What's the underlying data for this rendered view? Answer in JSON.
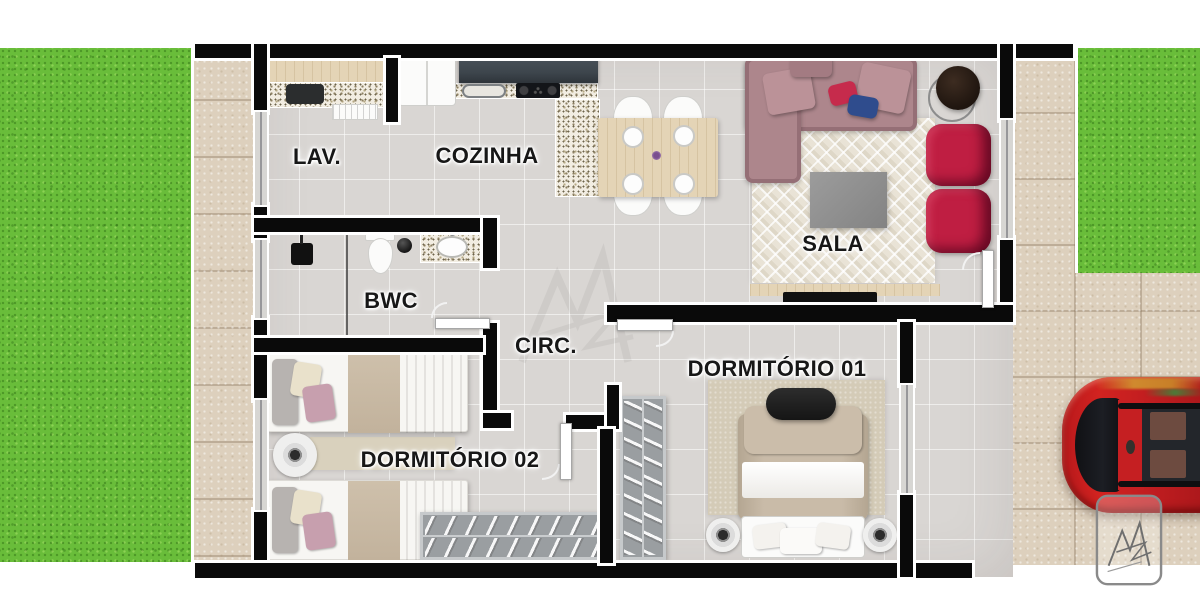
{
  "rooms": {
    "lav": "LAV.",
    "cozinha": "COZINHA",
    "sala": "SALA",
    "bwc": "BWC",
    "circ": "CIRC.",
    "dorm1": "DORMITÓRIO 01",
    "dorm2": "DORMITÓRIO 02"
  },
  "colors": {
    "grass": "#69bd3a",
    "paving": "#ddd0bd",
    "floor": "#d9d6d3",
    "wall": "#0a0a0a",
    "sofa": "#ad868c",
    "armchair": "#bf1e42",
    "cushion_red": "#c62b4c",
    "cushion_blue": "#2f4c8d",
    "car": "#d22320",
    "rug": "#e9e3d6",
    "wood": "#e4d4b6",
    "counter_dark": "#3e464d",
    "watermark": "#8a8a8a"
  }
}
